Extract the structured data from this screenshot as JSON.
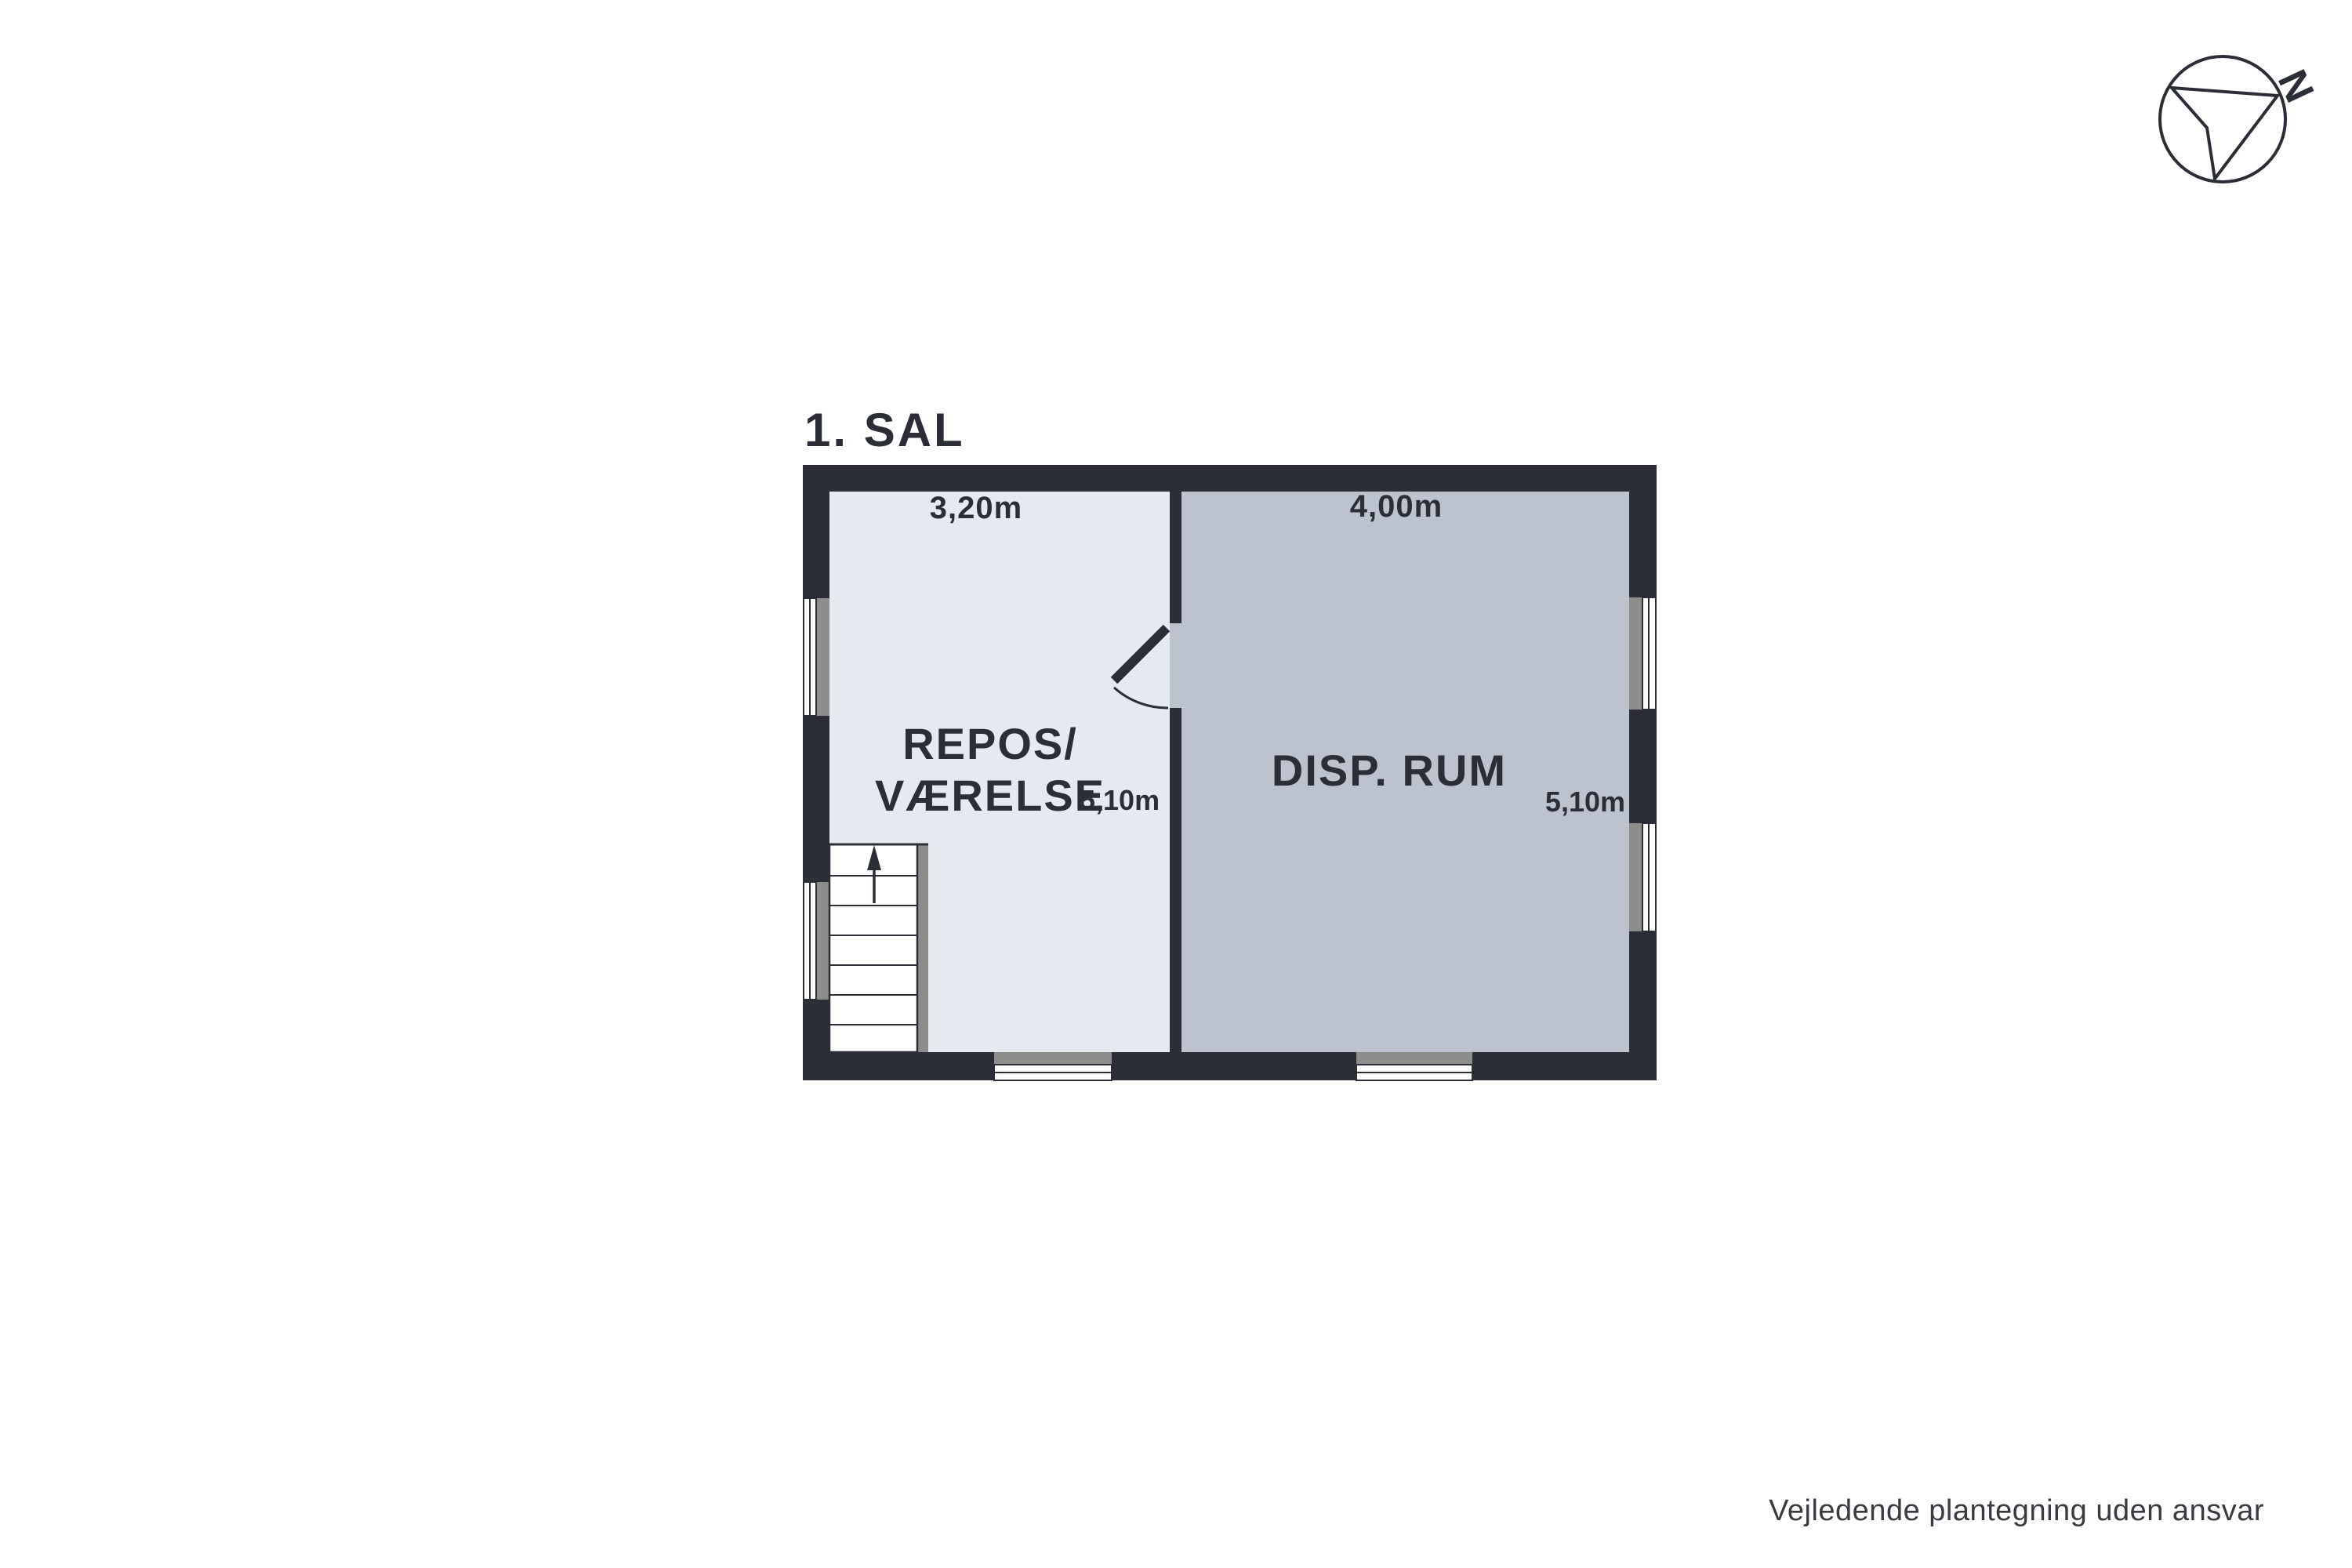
{
  "header": {
    "floor_title": "1. SAL"
  },
  "compass": {
    "north_label": "N"
  },
  "floor_plan": {
    "rooms": [
      {
        "id": "repos-vaerelse",
        "label_line1": "REPOS/",
        "label_line2": "VÆRELSE",
        "width_label": "3,20m",
        "depth_label": "5,10m"
      },
      {
        "id": "disp-rum",
        "label": "DISP. RUM",
        "width_label": "4,00m",
        "depth_label": "5,10m"
      }
    ]
  },
  "footer": {
    "disclaimer": "Vejledende plantegning uden ansvar"
  },
  "colors": {
    "wall": "#2b2e37",
    "room_light": "#e5eaf1",
    "room_dark": "#bdc3ce",
    "window_sill": "#8d8d8b",
    "window_pane": "#ffffff",
    "text_dark": "#2b2e36",
    "disclaimer_text": "#383c42",
    "background": "#ffffff"
  }
}
